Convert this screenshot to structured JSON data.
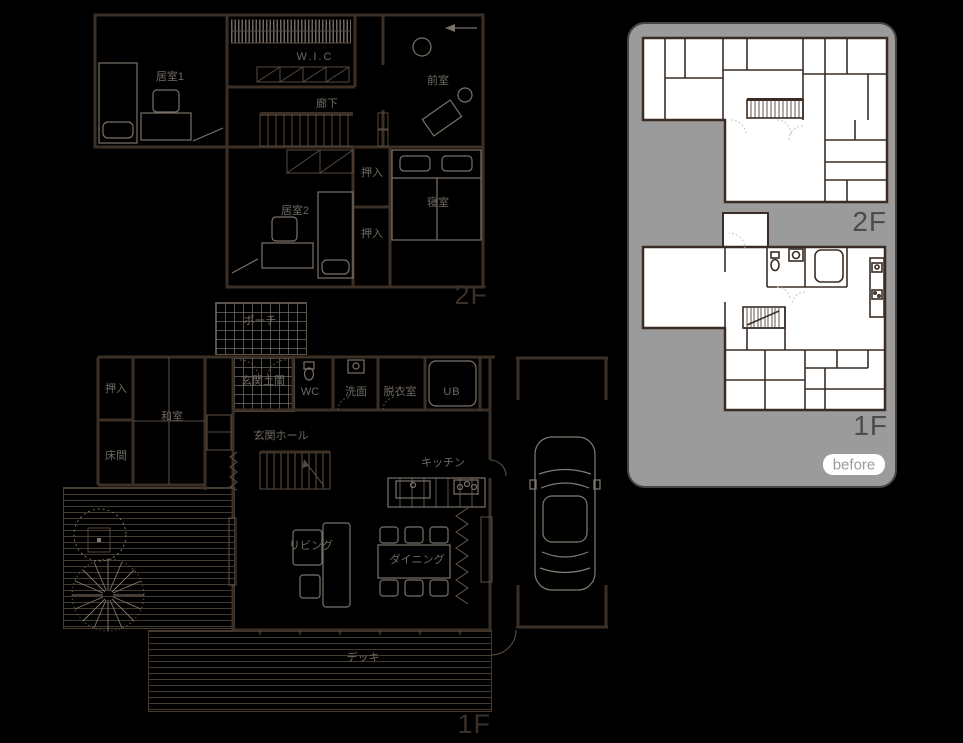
{
  "page": {
    "background": "#000000"
  },
  "colors": {
    "plan_wall": "#3c2f26",
    "plan_thin": "#584a3e",
    "plan_furniture": "#7a7269",
    "plan_text": "#6f6961",
    "plan_floor_label": "#3b3027",
    "vehicle_and_tree": "#837b72",
    "panel_background": "#9b9b9b",
    "panel_wall": "#3a2d25",
    "panel_room_fill": "#ffffff",
    "panel_label": "#4c4c4c",
    "badge_background": "#ffffff",
    "badge_text": "#9b9b9b"
  },
  "after_plans": {
    "f2": {
      "floor_label": "2F",
      "rooms": {
        "room1": "居室1",
        "wic": "W.I.C",
        "hallway": "廊下",
        "anteroom": "前室",
        "room2": "居室2",
        "closet_upper": "押入",
        "closet_lower": "押入",
        "bedroom": "寝室"
      }
    },
    "f1": {
      "floor_label": "1F",
      "rooms": {
        "porch": "ポーチ",
        "closet": "押入",
        "washitsu": "和室",
        "tokonoma": "床間",
        "entrance_doma": "玄関土間",
        "wc": "WC",
        "washroom": "洗面",
        "dressing_room": "脱衣室",
        "unit_bath": "UB",
        "entrance_hall": "玄関ホール",
        "kitchen": "キッチン",
        "living": "リビング",
        "dining": "ダイニング",
        "deck": "デッキ"
      }
    }
  },
  "before_panel": {
    "f2_label": "2F",
    "f1_label": "1F",
    "badge_label": "before"
  }
}
